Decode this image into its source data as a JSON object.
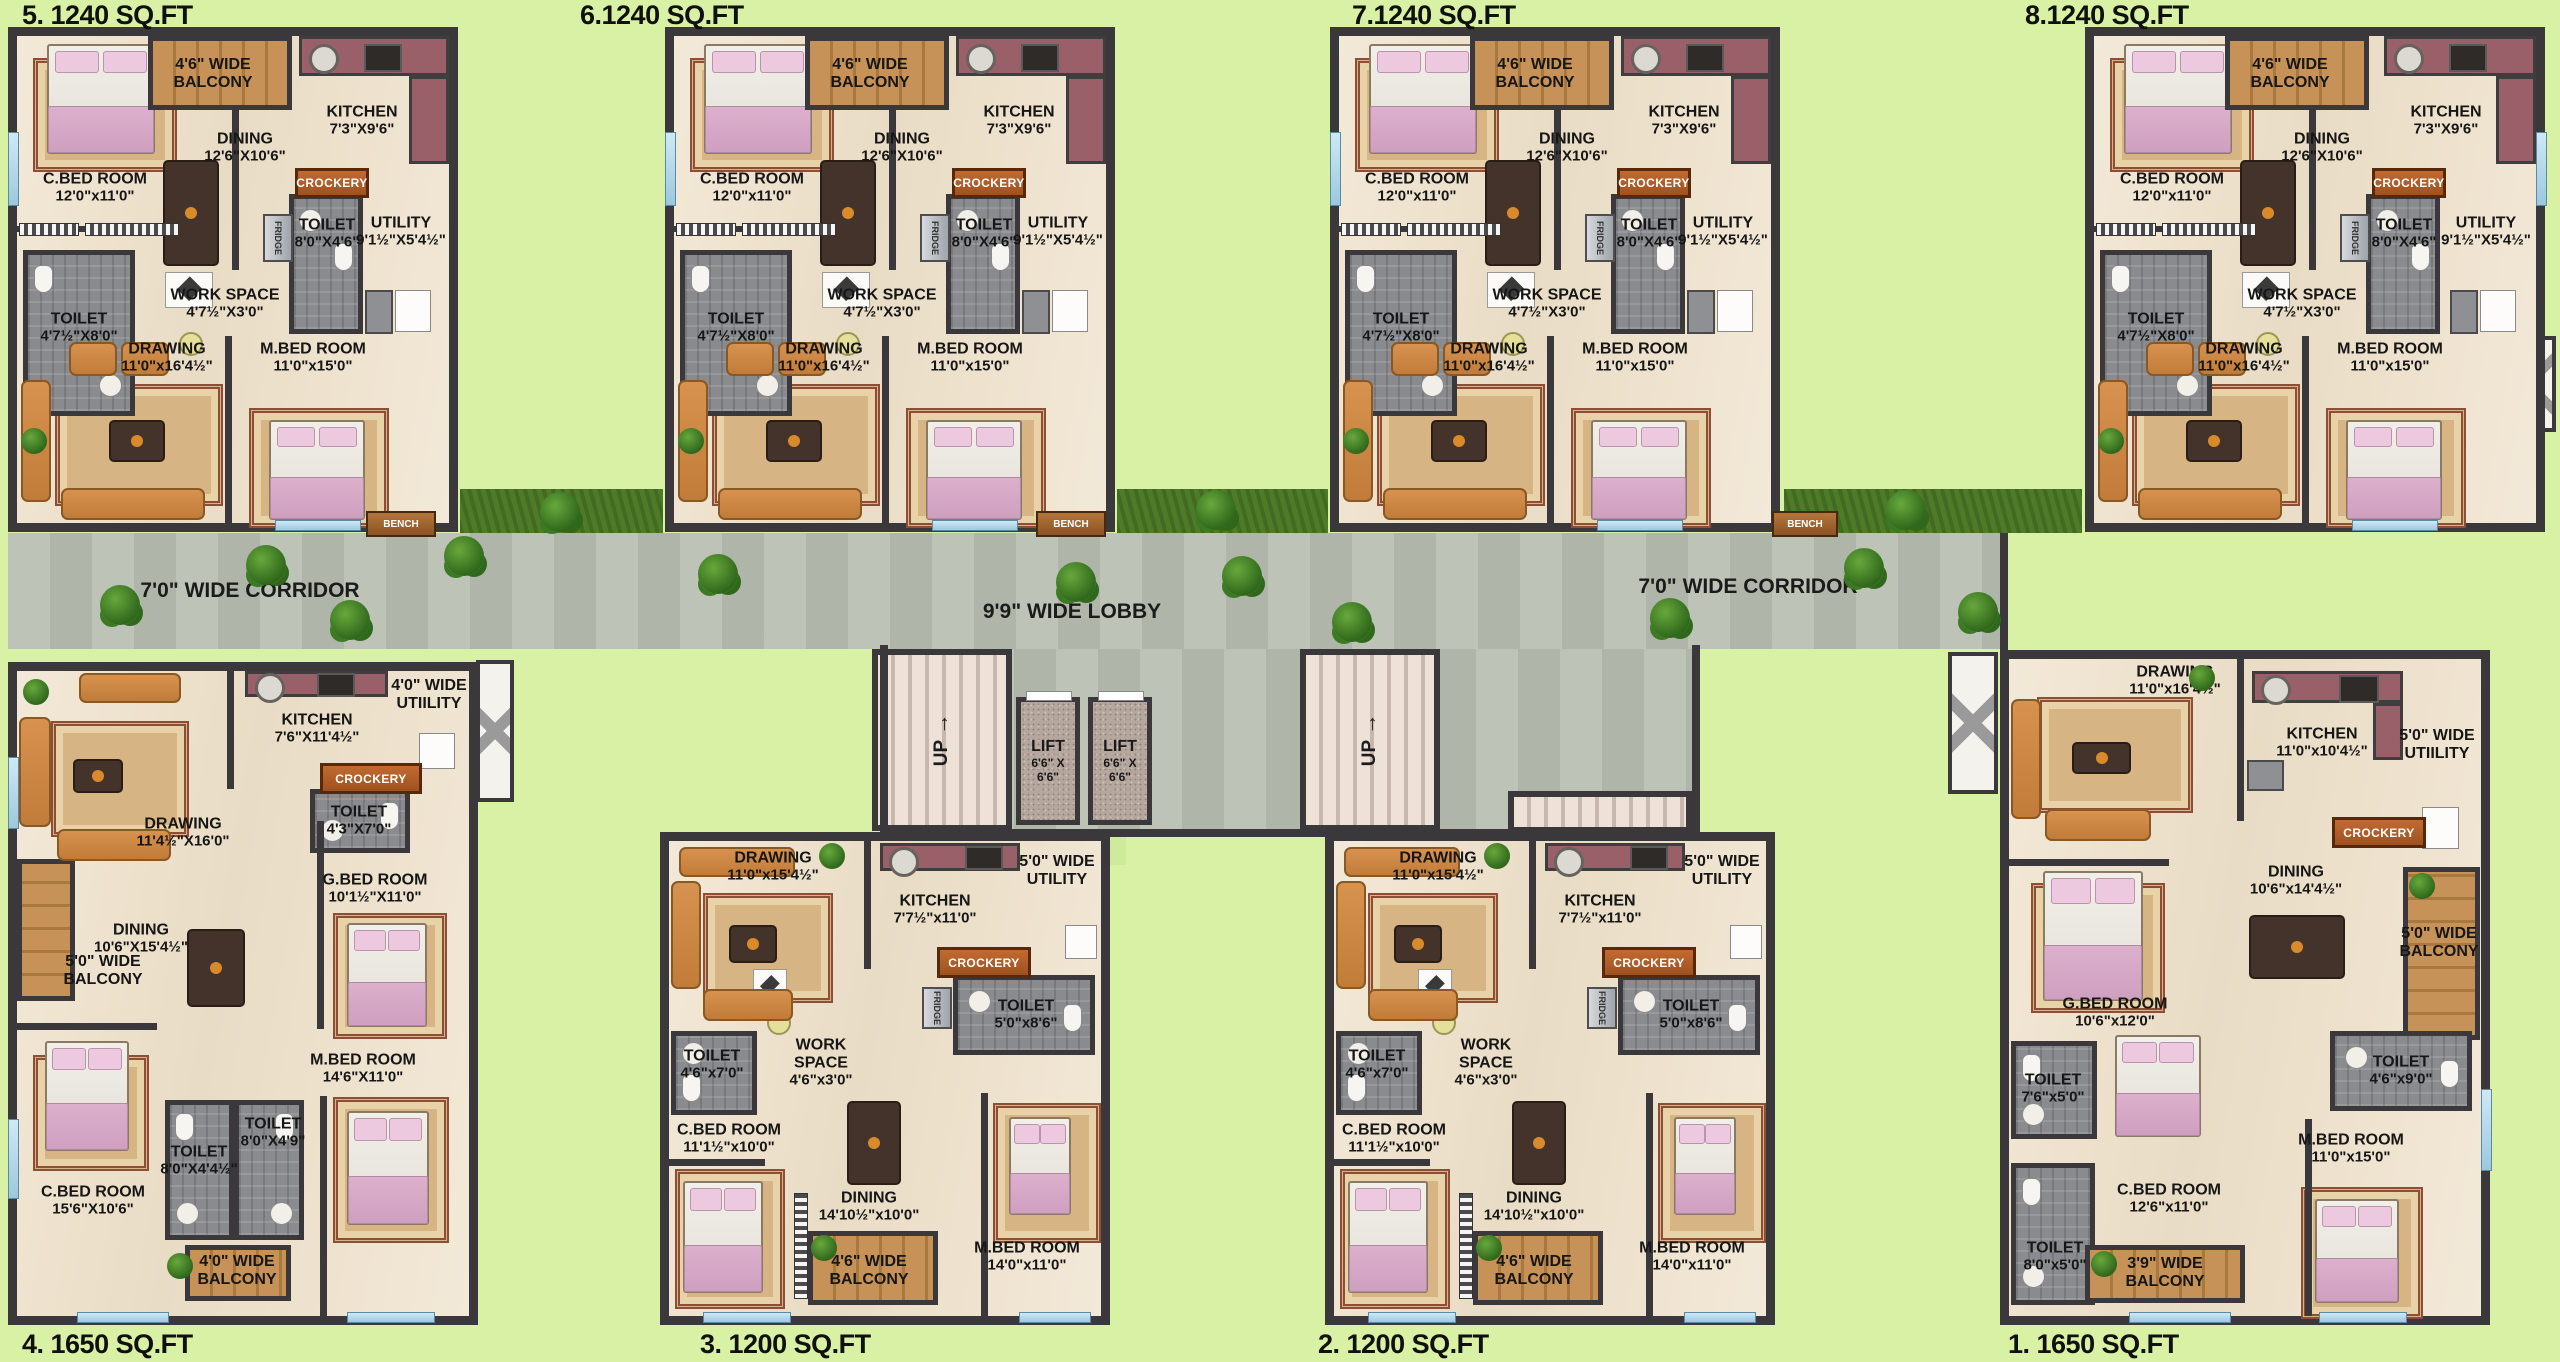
{
  "palette": {
    "background": "#d9f1a4",
    "wall": "#3a383b",
    "floor": "#f0e5d2",
    "toilet_floor": "#8a8b8f",
    "corridor": "#b9bfb2",
    "balcony_wood": "#b98a50",
    "kitchen_counter": "#99606a",
    "crockery_bar": "#b05c28",
    "sofa": "#cd8644",
    "bed_blanket": "#d6a8c6",
    "grass": "#4d7b27",
    "lift_floor": "#b6a79e"
  },
  "titles": {
    "top": [
      "5. 1240 SQ.FT",
      "6.1240 SQ.FT",
      "7.1240 SQ.FT",
      "8.1240 SQ.FT"
    ],
    "bottom": [
      "4. 1650 SQ.FT",
      "3. 1200 SQ.FT",
      "2. 1200 SQ.FT",
      "1. 1650 SQ.FT"
    ]
  },
  "common": {
    "crockery": "CROCKERY",
    "fridge": "FRIDGE",
    "bench": "BENCH",
    "up": "UP",
    "lift": "LIFT",
    "lift_dims": "6'6\" X 6'6\"",
    "corridor": "7'0\" WIDE CORRIDOR",
    "lobby": "9'9\" WIDE LOBBY"
  },
  "top_rooms": {
    "cbed": {
      "name": "C.BED ROOM",
      "dims": "12'0\"x11'0\""
    },
    "balcony": {
      "l1": "4'6\" WIDE",
      "l2": "BALCONY"
    },
    "kitchen": {
      "name": "KITCHEN",
      "dims": "7'3\"X9'6\""
    },
    "dining": {
      "name": "DINING",
      "dims": "12'6\"X10'6\""
    },
    "toilet_top": {
      "name": "TOILET",
      "dims": "8'0\"X4'6\""
    },
    "utility": {
      "name": "UTILITY",
      "dims": "9'1½\"X5'4½\""
    },
    "toilet_left": {
      "name": "TOILET",
      "dims": "4'7½\"X8'0\""
    },
    "work": {
      "l1": "WORK SPACE",
      "dims": "4'7½\"X3'0\""
    },
    "drawing": {
      "name": "DRAWING",
      "dims": "11'0\"x16'4½\""
    },
    "mbed": {
      "name": "M.BED ROOM",
      "dims": "11'0\"x15'0\""
    }
  },
  "unit4_rooms": {
    "drawing": {
      "name": "DRAWING",
      "dims": "11'4½\"X16'0\""
    },
    "kitchen": {
      "name": "KITCHEN",
      "dims": "7'6\"X11'4½\""
    },
    "utility": {
      "l1": "4'0\" WIDE",
      "l2": "UTIILITY"
    },
    "toilet_kit": {
      "name": "TOILET",
      "dims": "4'3\"X7'0\""
    },
    "gbed": {
      "name": "G.BED ROOM",
      "dims": "10'1½\"X11'0\""
    },
    "dining": {
      "name": "DINING",
      "dims": "10'6\"X15'4½\""
    },
    "balcony_side": {
      "l1": "5'0\" WIDE",
      "l2": "BALCONY"
    },
    "mbed": {
      "name": "M.BED ROOM",
      "dims": "14'6\"X11'0\""
    },
    "toilet_a": {
      "name": "TOILET",
      "dims": "8'0\"X4'4½\""
    },
    "toilet_b": {
      "name": "TOILET",
      "dims": "8'0\"X4'9\""
    },
    "cbed": {
      "name": "C.BED ROOM",
      "dims": "15'6\"X10'6\""
    },
    "balcony_bottom": {
      "l1": "4'0\" WIDE",
      "l2": "BALCONY"
    }
  },
  "mid_rooms": {
    "drawing": {
      "name": "DRAWING",
      "dims": "11'0\"x15'4½\""
    },
    "kitchen": {
      "name": "KITCHEN",
      "dims": "7'7½\"x11'0\""
    },
    "utility": {
      "l1": "5'0\" WIDE",
      "l2": "UTILITY"
    },
    "toilet_top": {
      "name": "TOILET",
      "dims": "5'0\"x8'6\""
    },
    "toilet_left": {
      "name": "TOILET",
      "dims": "4'6\"x7'0\""
    },
    "work": {
      "l1": "WORK",
      "l2": "SPACE",
      "dims": "4'6\"x3'0\""
    },
    "cbed": {
      "name": "C.BED ROOM",
      "dims": "11'1½\"x10'0\""
    },
    "dining": {
      "name": "DINING",
      "dims": "14'10½\"x10'0\""
    },
    "balcony": {
      "l1": "4'6\" WIDE",
      "l2": "BALCONY"
    },
    "mbed": {
      "name": "M.BED ROOM",
      "dims": "14'0\"x11'0\""
    }
  },
  "unit1_rooms": {
    "drawing": {
      "name": "DRAWING",
      "dims": "11'0\"x16'4½\""
    },
    "kitchen": {
      "name": "KITCHEN",
      "dims": "11'0\"x10'4½\""
    },
    "utility": {
      "l1": "5'0\" WIDE",
      "l2": "UTIILITY"
    },
    "dining": {
      "name": "DINING",
      "dims": "10'6\"x14'4½\""
    },
    "balcony_side": {
      "l1": "5'0\" WIDE",
      "l2": "BALCONY"
    },
    "gbed": {
      "name": "G.BED ROOM",
      "dims": "10'6\"x12'0\""
    },
    "toilet_a": {
      "name": "TOILET",
      "dims": "7'6\"x5'0\""
    },
    "toilet_b": {
      "name": "TOILET",
      "dims": "8'0\"x5'0\""
    },
    "cbed": {
      "name": "C.BED ROOM",
      "dims": "12'6\"x11'0\""
    },
    "balcony_bottom": {
      "l1": "3'9\" WIDE",
      "l2": "BALCONY"
    },
    "mbed": {
      "name": "M.BED ROOM",
      "dims": "11'0\"x15'0\""
    },
    "toilet_c": {
      "name": "TOILET",
      "dims": "4'6\"x9'0\""
    }
  }
}
